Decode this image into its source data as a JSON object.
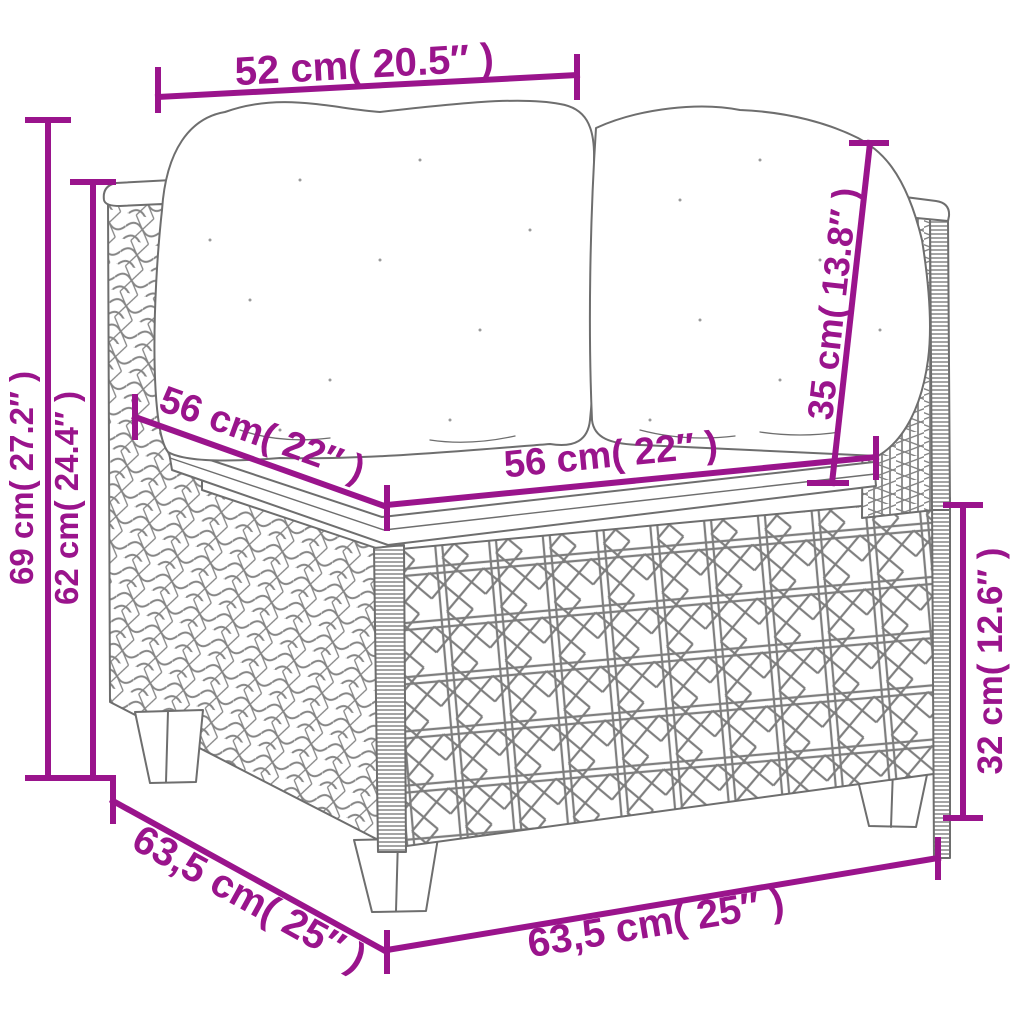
{
  "diagram": {
    "subject": "rattan-corner-sofa-dimension-drawing",
    "colors": {
      "dimension_annotation": "#9A148C",
      "line_art": "#6E6E6E",
      "background": "#FFFFFF"
    },
    "dimensions": {
      "back_width": "52 cm( 20.5″ )",
      "overall_height": "69 cm( 27.2″ )",
      "armrest_height": "62 cm( 24.4″ )",
      "seat_depth": "56 cm( 22″ )",
      "seat_width": "56 cm( 22″ )",
      "back_cushion_height": "35 cm( 13.8″ )",
      "base_height": "32 cm( 12.6″ )",
      "overall_depth": "63,5 cm( 25″ )",
      "overall_width": "63,5 cm( 25″ )"
    }
  }
}
